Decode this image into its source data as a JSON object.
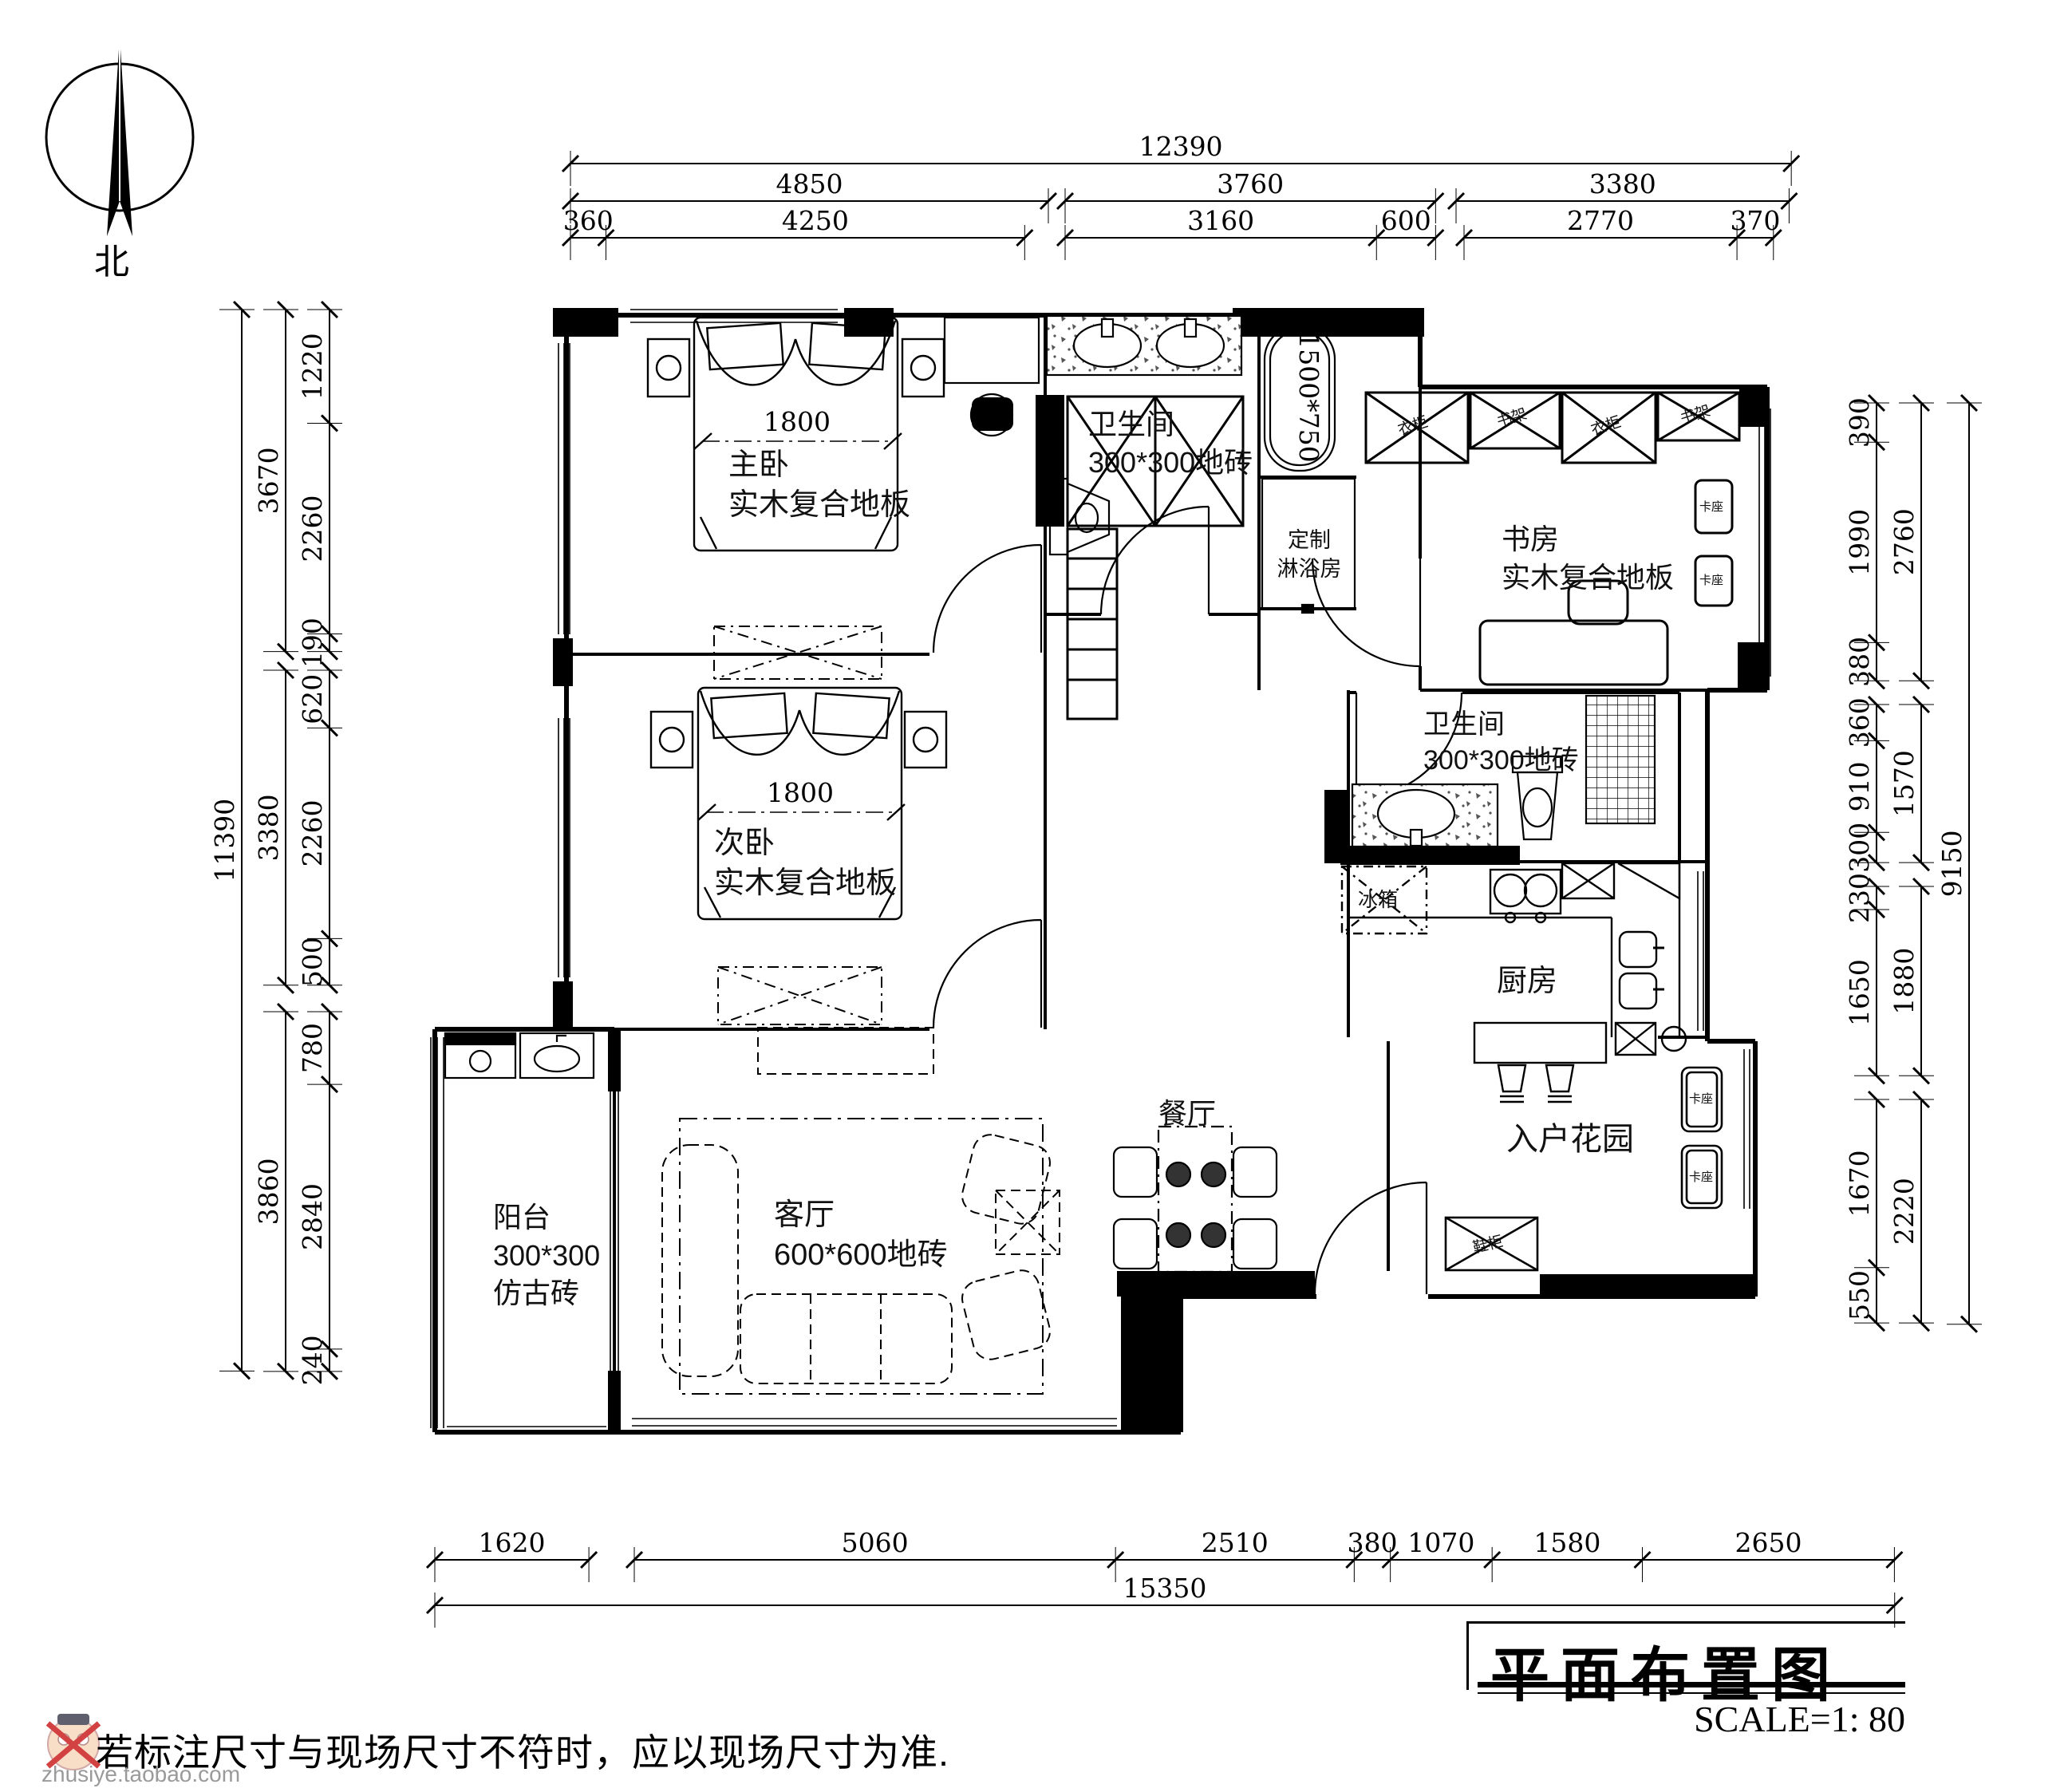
{
  "title_block": {
    "title": "平面布置图",
    "scale": "SCALE=1: 80"
  },
  "note": "若标注尺寸与现场尺寸不符时，应以现场尺寸为准.",
  "watermark": "zhusiye.taobao.com",
  "compass": {
    "label": "北"
  },
  "rooms": {
    "master_bedroom": {
      "name": "主卧",
      "floor": "实木复合地板"
    },
    "bathroom_top": {
      "name": "卫生间",
      "floor": "300*300地砖"
    },
    "shower_room": {
      "line1": "定制",
      "line2": "淋浴房"
    },
    "study": {
      "name": "书房",
      "floor": "实木复合地板"
    },
    "second_bedroom": {
      "name": "次卧",
      "floor": "实木复合地板"
    },
    "bathroom_mid": {
      "name": "卫生间",
      "floor": "300*300地砖"
    },
    "kitchen": {
      "name": "厨房"
    },
    "entry_garden": {
      "name": "入户花园"
    },
    "dining": {
      "name": "餐厅"
    },
    "living": {
      "name": "客厅",
      "floor": "600*600地砖"
    },
    "balcony": {
      "name": "阳台",
      "floor": "300*300",
      "floor2": "仿古砖"
    }
  },
  "furniture_labels": {
    "fridge": "冰箱",
    "wardrobe": "衣柜",
    "bookshelf": "书架",
    "seat": "卡座",
    "shoe_cabinet": "鞋柜",
    "bed_width": "1800",
    "bathtub_size": "1500*750"
  },
  "dimensions": {
    "top": {
      "overall": [
        12390
      ],
      "mid": [
        [
          4850
        ],
        [
          3760
        ],
        [
          3380
        ]
      ],
      "inner": [
        [
          360,
          4250
        ],
        [
          3160,
          600
        ],
        [
          2770,
          370
        ]
      ]
    },
    "left": {
      "overall": [
        11390
      ],
      "mid": [
        [
          3670
        ],
        [
          3380
        ],
        [
          3860
        ]
      ],
      "inner": [
        [
          1220,
          2260,
          190
        ],
        [
          620,
          2260,
          500
        ],
        [
          780,
          2840,
          240
        ]
      ]
    },
    "right": {
      "overall": [
        9150
      ],
      "mid": [
        [
          2760
        ],
        [
          1570
        ],
        [
          1880
        ],
        [
          2220
        ]
      ],
      "inner": [
        [
          390,
          1990,
          380
        ],
        [
          360,
          910,
          300
        ],
        [
          230,
          1650
        ],
        [
          1670,
          550
        ]
      ]
    },
    "bottom": {
      "row": [
        [
          1620
        ],
        [
          5060,
          2510,
          380,
          1070,
          1580,
          2650
        ]
      ],
      "overall": [
        15350
      ]
    }
  }
}
